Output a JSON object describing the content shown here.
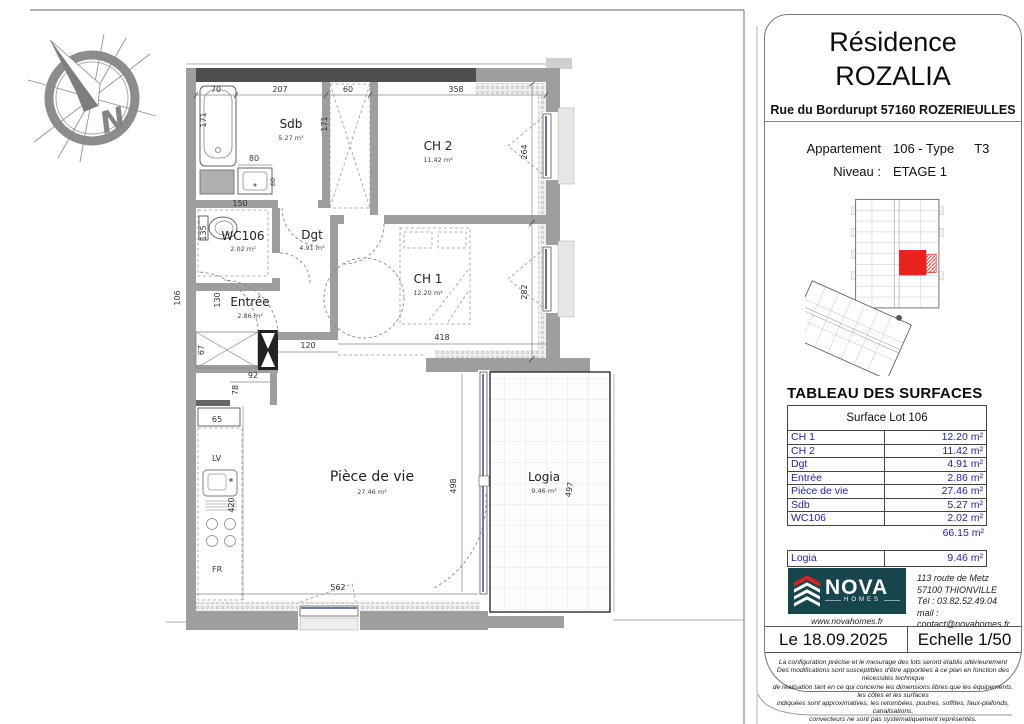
{
  "colors": {
    "accent_red": "#e8231d",
    "table_blue": "#2222b2",
    "logo_teal": "#16454e",
    "wall_gray": "#9e9e9e",
    "wall_dark": "#4f4f4f"
  },
  "compass": {
    "north": "N"
  },
  "plan": {
    "rooms": [
      {
        "label": "Sdb",
        "area": "5.27 m²"
      },
      {
        "label": "CH 2",
        "area": "11.42 m²"
      },
      {
        "label": "WC106",
        "area": "2.02 m²"
      },
      {
        "label": "Dgt",
        "area": "4.91 m²"
      },
      {
        "label": "Entrée",
        "area": "2.86 m²"
      },
      {
        "label": "CH 1",
        "area": "12.20 m²"
      },
      {
        "label": "Pièce de vie",
        "area": "27.46 m²"
      },
      {
        "label": "Logia",
        "area": "9.46 m²"
      }
    ],
    "kitchen": {
      "lv": "LV",
      "fr": "FR"
    },
    "dims": {
      "tub_w": "70",
      "sdb_top": "207",
      "placard": "60",
      "ch2_top": "358",
      "tub_h": "171",
      "sdb_right": "171",
      "vanity": "80",
      "vanity_d": "60",
      "wc_w": "150",
      "wc_h": "135",
      "left_out": "106",
      "entree_h": "130",
      "shaft": "67",
      "hall": "120",
      "kitchen_nook": "92",
      "kitchen_d": "78",
      "kitchen_unit": "65",
      "kitchen_run": "420",
      "ch2_h": "264",
      "ch1_h": "282",
      "ch1_w": "418",
      "pdv_w": "562",
      "bay": "498",
      "logia_h": "497"
    }
  },
  "title_block": {
    "line1": "Résidence",
    "line2": "ROZALIA",
    "address": "Rue du Bordurupt 57160 ROZERIEULLES",
    "apt_label": "Appartement",
    "apt_value": "106 - Type",
    "apt_type": "T3",
    "lvl_label": "Niveau :",
    "lvl_value": "ETAGE 1"
  },
  "surfaces": {
    "title": "TABLEAU DES SURFACES",
    "header": "Surface Lot 106",
    "rows": [
      {
        "label": "CH 1",
        "value": "12.20 m²"
      },
      {
        "label": "CH 2",
        "value": "11.42 m²"
      },
      {
        "label": "Dgt",
        "value": "4.91 m²"
      },
      {
        "label": "Entrée",
        "value": "2.86 m²"
      },
      {
        "label": "Pièce de vie",
        "value": "27.46 m²"
      },
      {
        "label": "Sdb",
        "value": "5.27 m²"
      },
      {
        "label": "WC106",
        "value": "2.02 m²"
      }
    ],
    "total": "66.15 m²",
    "logia": {
      "label": "Logia",
      "value": "9.46 m²"
    }
  },
  "company": {
    "name": "NOVA",
    "homes": "HOMES",
    "website": "www.novahomes.fr",
    "address1": "113 route de Metz",
    "address2": "57100 THIONVILLE",
    "phone": "Tél : 03.82.52.49.04",
    "email": "mail : contact@novahomes.fr"
  },
  "footer": {
    "date": "Le 18.09.2025",
    "scale": "Echelle 1/50",
    "disclaimer": [
      "La configuration précise et le mesurage des lots seront établis ultérieurement",
      "Des modifications sont susceptibles d'être apportées à ce plan en fonction des nécessités technique",
      "de réalisation tant en ce qui concerne les dimensions libres que les équipements. les côtes et les surfaces",
      "indiquées sont approximatives, les retombées, poutres, soffites, faux-plafonds, canalisations,",
      "convecteurs ne sont pas systématiquement représentés.",
      "Les indications de plantations ne sont pas contractuelles."
    ]
  }
}
